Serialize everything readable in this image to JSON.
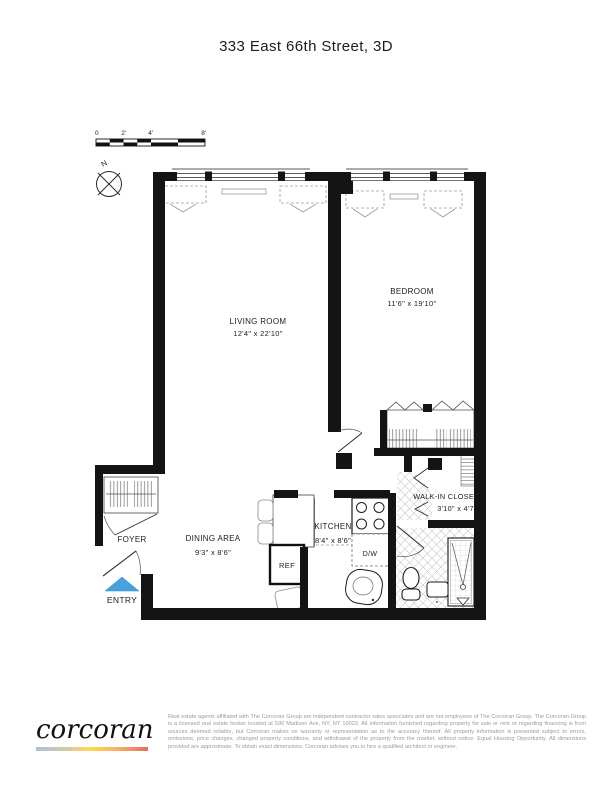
{
  "page": {
    "title": "333 East 66th Street, 3D"
  },
  "floor_plan": {
    "compass_label": "N",
    "scale_bar": {
      "ticks": [
        "0",
        "2'",
        "4'",
        "8'"
      ]
    },
    "rooms": {
      "living_room": {
        "name": "LIVING ROOM",
        "dims": "12'4\" x 22'10\""
      },
      "bedroom": {
        "name": "BEDROOM",
        "dims": "11'6\" x 19'10\""
      },
      "dining_area": {
        "name": "DINING AREA",
        "dims": "9'3\" x 8'6\""
      },
      "kitchen": {
        "name": "KITCHEN",
        "dims": "8'4\" x 8'6\""
      },
      "walk_in_closet": {
        "name": "WALK-IN CLOSET",
        "dims": "3'10\" x 4'7\""
      },
      "foyer": {
        "name": "FOYER"
      }
    },
    "fixtures": {
      "refrigerator": "REF",
      "dishwasher": "D/W"
    },
    "entry": {
      "label": "ENTRY"
    },
    "colors": {
      "walls": "#141414",
      "entry_arrow": "#47A1DC",
      "entry_label": "#7FB9E3"
    }
  },
  "footer": {
    "logo_text": "corcoran",
    "logo_gradient": [
      "#A9C3DA",
      "#D6C9A7",
      "#FFD952",
      "#F6B066",
      "#EC6B68"
    ],
    "disclaimer": "Real estate agents affiliated with The Corcoran Group are independent contractor sales associates and are not employees of The Corcoran Group. The Corcoran Group is a licensed real estate broker located at 590 Madison Ave, NY, NY 10022. All information furnished regarding property for sale or rent or regarding financing is from sources deemed reliable, but Corcoran makes no warranty or representation as to the accuracy thereof. All property information is presented subject to errors, omissions, price changes, changed property conditions, and withdrawal of the property from the market, without notice. Equal Housing Opportunity. All dimensions provided are approximate. To obtain exact dimensions, Corcoran advises you to hire a qualified architect or engineer."
  }
}
